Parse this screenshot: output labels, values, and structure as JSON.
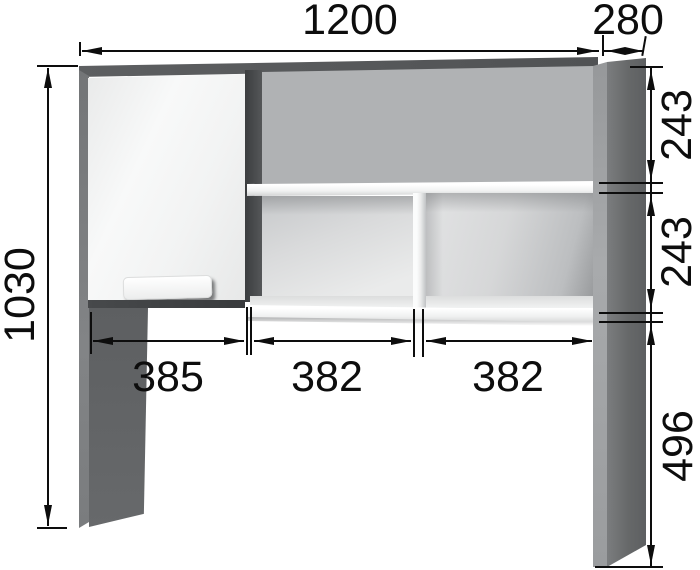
{
  "drawing": {
    "kind": "furniture-dimension-diagram",
    "dimensions": {
      "top_width": "1200",
      "top_depth": "280",
      "left_height": "1030",
      "right_upper": "243",
      "right_middle": "243",
      "right_lower": "496",
      "bottom_left": "385",
      "bottom_center": "382",
      "bottom_right": "382"
    },
    "colors": {
      "line": "#0d0d0d",
      "panel_dark": "#58595b",
      "panel_mid": "#6e7071",
      "panel_highlight": "#a6a8aa",
      "front_white": "#f5f6f6",
      "interior_gray": "#b3b5b7",
      "background": "#ffffff"
    }
  }
}
